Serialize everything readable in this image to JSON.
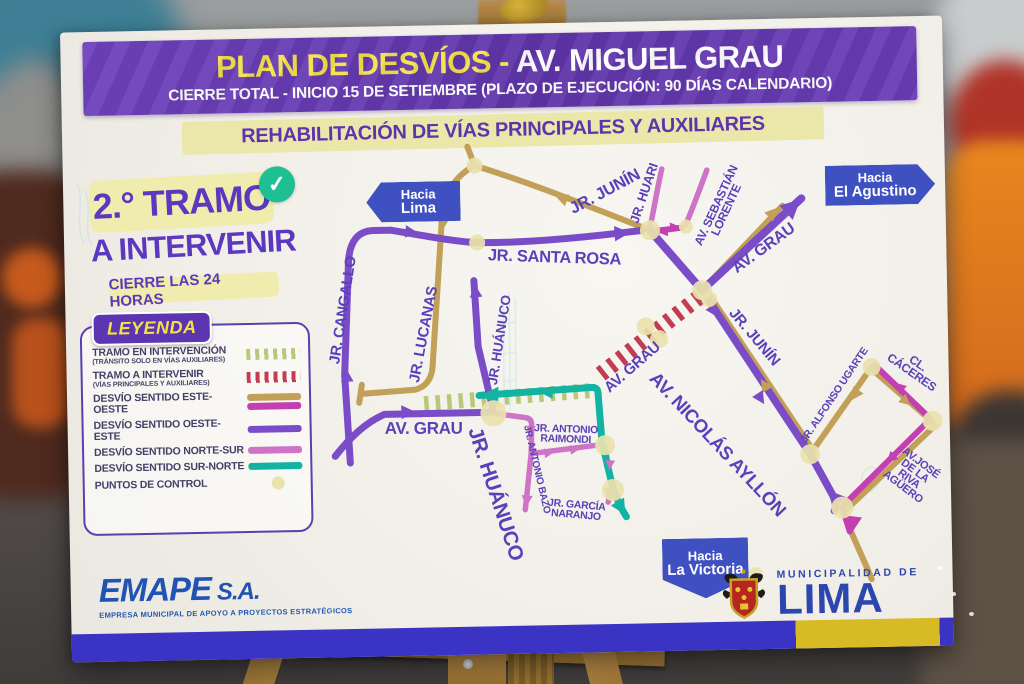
{
  "board": {
    "title_part1": "PLAN DE DESVÍOS - ",
    "title_part2": "AV. MIGUEL GRAU",
    "subtitle": "CIERRE TOTAL - INICIO 15 DE SETIEMBRE (PLAZO DE EJECUCIÓN: 90 DÍAS CALENDARIO)",
    "banner": "REHABILITACIÓN DE VÍAS PRINCIPALES Y AUXILIARES"
  },
  "tramo_panel": {
    "line1": "2.° TRAMO",
    "line2": "A INTERVENIR",
    "line3": "CIERRE LAS 24 HORAS",
    "check_icon": "✓"
  },
  "legend": {
    "title": "LEYENDA",
    "items": [
      {
        "label": "TRAMO EN INTERVENCIÓN",
        "sub": "(TRÁNSITO SOLO EN VÍAS AUXILIARES)",
        "swatch": {
          "type": "hatch",
          "colors": [
            "#b9c878"
          ]
        }
      },
      {
        "label": "TRAMO A INTERVENIR",
        "sub": "(VÍAS PRINCIPALES Y AUXILIARES)",
        "swatch": {
          "type": "hatch",
          "colors": [
            "#c23c52"
          ]
        }
      },
      {
        "label": "DESVÍO SENTIDO ESTE-OESTE",
        "sub": "",
        "swatch": {
          "type": "bars",
          "colors": [
            "#c2a058",
            "#c43fb2"
          ]
        }
      },
      {
        "label": "DESVÍO SENTIDO OESTE-ESTE",
        "sub": "",
        "swatch": {
          "type": "bars",
          "colors": [
            "#7a4cc8"
          ]
        }
      },
      {
        "label": "DESVÍO SENTIDO NORTE-SUR",
        "sub": "",
        "swatch": {
          "type": "bars",
          "colors": [
            "#cd74c6"
          ]
        }
      },
      {
        "label": "DESVÍO SENTIDO SUR-NORTE",
        "sub": "",
        "swatch": {
          "type": "bars",
          "colors": [
            "#13b3a3"
          ]
        }
      },
      {
        "label": "PUNTOS DE CONTROL",
        "sub": "",
        "swatch": {
          "type": "dot",
          "colors": [
            "#e9e2ad"
          ]
        }
      }
    ]
  },
  "map": {
    "signs": [
      {
        "id": "lima",
        "line1": "Hacia",
        "line2": "Lima",
        "dir": "left",
        "x": 345,
        "y": 176,
        "w": 84,
        "h": 40
      },
      {
        "id": "el-agustino",
        "line1": "Hacia",
        "line2": "El Agustino",
        "dir": "right",
        "x": 812,
        "y": 168,
        "w": 100,
        "h": 40
      },
      {
        "id": "la-victoria",
        "line1": "Hacia",
        "line2": "La Victoria",
        "dir": "down",
        "x": 635,
        "y": 543,
        "w": 86,
        "h": 50
      }
    ],
    "streets": [
      {
        "id": "cangallo",
        "label": "JR. CANGALLO",
        "x": 278,
        "y": 283,
        "rot": -80,
        "size": 15
      },
      {
        "id": "lucanas",
        "label": "JR. LUCANAS",
        "x": 358,
        "y": 309,
        "rot": -78,
        "size": 15
      },
      {
        "id": "huanuco-norte",
        "label": "JR. HUÁNUCO",
        "x": 434,
        "y": 316,
        "rot": -80,
        "size": 13.5
      },
      {
        "id": "santa-rosa",
        "label": "JR. SANTA ROSA",
        "x": 490,
        "y": 235,
        "rot": 3,
        "size": 16.5
      },
      {
        "id": "junin-oeste",
        "label": "JR. JUNÍN",
        "x": 542,
        "y": 170,
        "rot": -27,
        "size": 16.5
      },
      {
        "id": "huari",
        "label": "JR. HUARI",
        "x": 581,
        "y": 172,
        "rot": -70,
        "size": 13
      },
      {
        "id": "sebastian-lorente",
        "lines": [
          "AV. SEBASTIÁN",
          "LORENTE"
        ],
        "x": 658,
        "y": 188,
        "rot": -64,
        "size": 12
      },
      {
        "id": "grau-noreste",
        "label": "AV. GRAU",
        "x": 700,
        "y": 230,
        "rot": -35,
        "size": 16
      },
      {
        "id": "grau-centro",
        "label": "AV. GRAU",
        "x": 566,
        "y": 346,
        "rot": -40,
        "size": 15
      },
      {
        "id": "junin-sureste",
        "label": "JR. JUNÍN",
        "x": 688,
        "y": 318,
        "rot": 51,
        "size": 15
      },
      {
        "id": "nicolas-ayllon",
        "label": "AV. NICOLÁS AYLLÓN",
        "x": 650,
        "y": 424,
        "rot": 48,
        "size": 18.5
      },
      {
        "id": "alfonso-ugarte",
        "label": "JR. ALFONSO UGARTE",
        "x": 768,
        "y": 378,
        "rot": -55,
        "size": 10.5
      },
      {
        "id": "caceres",
        "label": "CL. CÁCERES",
        "x": 848,
        "y": 352,
        "rot": 36,
        "size": 12
      },
      {
        "id": "riva-aguero",
        "lines": [
          "AV.JOSÉ DE LA",
          "RIVA AGÜERO"
        ],
        "x": 843,
        "y": 459,
        "rot": 38,
        "size": 11
      },
      {
        "id": "grau-oeste",
        "label": "AV. GRAU",
        "x": 356,
        "y": 403,
        "rot": 1,
        "size": 17
      },
      {
        "id": "huanuco-sur",
        "label": "JR. HUÁNUCO",
        "x": 426,
        "y": 470,
        "rot": 73,
        "size": 20.5
      },
      {
        "id": "antonio-bazo",
        "label": "JR. ANTONIO BAZO",
        "x": 468,
        "y": 446,
        "rot": 78,
        "size": 10
      },
      {
        "id": "antonio-raimondi",
        "lines": [
          "JR. ANTONIO",
          "RAIMONDI"
        ],
        "x": 498,
        "y": 412,
        "rot": 3,
        "size": 10.5
      },
      {
        "id": "garcia-naranjo",
        "lines": [
          "JR. GARCÍA",
          "NARANJO"
        ],
        "x": 507,
        "y": 488,
        "rot": 6,
        "size": 10.5
      }
    ]
  },
  "footer": {
    "emape": "EMAPE",
    "emape_sa": " S.A.",
    "emape_sub": "EMPRESA MUNICIPAL DE APOYO A PROYECTOS ESTRATÉGICOS",
    "muni_line1": "MUNICIPALIDAD DE",
    "muni_line2": "LIMA"
  },
  "colors": {
    "title_bg": "#6a3db7",
    "title_yellow": "#f3e24a",
    "banner_bg": "#ebe7ab",
    "detour_este_oeste": "#c2a058",
    "detour_este_oeste_2": "#c43fb2",
    "detour_oeste_este": "#7a4cc8",
    "detour_norte_sur": "#cd74c6",
    "detour_sur_norte": "#13b3a3",
    "tramo_en_intervencion": "#b9c878",
    "tramo_a_intervenir": "#c23c52",
    "punto_control": "#e9e2ad",
    "sign_blue": "#3f51c1",
    "street_label": "#5a40ba",
    "emape_blue": "#2153b5",
    "lima_blue": "#2c46b0"
  }
}
